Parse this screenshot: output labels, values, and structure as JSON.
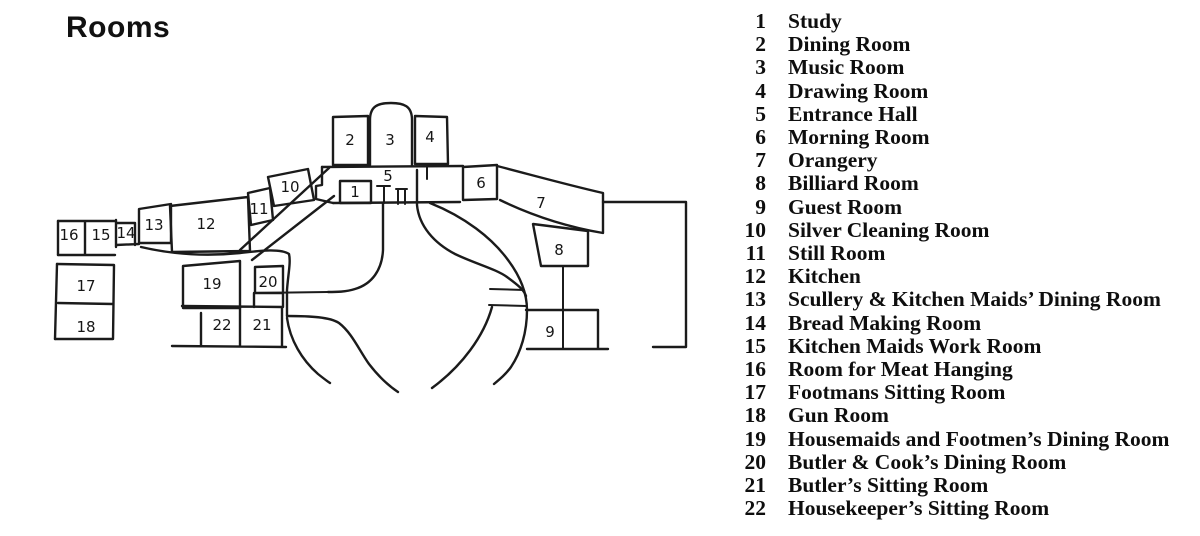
{
  "title": "Rooms",
  "colors": {
    "ink": "#1b1b1b",
    "paper": "#ffffff",
    "text": "#0e0e0e"
  },
  "legend": {
    "items": [
      {
        "num": "1",
        "name": "Study"
      },
      {
        "num": "2",
        "name": "Dining Room"
      },
      {
        "num": "3",
        "name": "Music Room"
      },
      {
        "num": "4",
        "name": "Drawing Room"
      },
      {
        "num": "5",
        "name": "Entrance Hall"
      },
      {
        "num": "6",
        "name": "Morning Room"
      },
      {
        "num": "7",
        "name": "Orangery"
      },
      {
        "num": "8",
        "name": "Billiard Room"
      },
      {
        "num": "9",
        "name": "Guest Room"
      },
      {
        "num": "10",
        "name": "Silver Cleaning Room"
      },
      {
        "num": "11",
        "name": "Still Room"
      },
      {
        "num": "12",
        "name": "Kitchen"
      },
      {
        "num": "13",
        "name": "Scullery & Kitchen Maids’ Dining Room"
      },
      {
        "num": "14",
        "name": "Bread Making Room"
      },
      {
        "num": "15",
        "name": "Kitchen Maids Work Room"
      },
      {
        "num": "16",
        "name": "Room for Meat Hanging"
      },
      {
        "num": "17",
        "name": "Footmans Sitting Room"
      },
      {
        "num": "18",
        "name": "Gun Room"
      },
      {
        "num": "19",
        "name": "Housemaids and Footmen’s Dining Room"
      },
      {
        "num": "20",
        "name": "Butler & Cook’s Dining Room"
      },
      {
        "num": "21",
        "name": "Butler’s Sitting Room"
      },
      {
        "num": "22",
        "name": "Housekeeper’s Sitting Room"
      }
    ]
  },
  "plan": {
    "labels": [
      {
        "num": "1"
      },
      {
        "num": "2"
      },
      {
        "num": "3"
      },
      {
        "num": "4"
      },
      {
        "num": "5"
      },
      {
        "num": "6"
      },
      {
        "num": "7"
      },
      {
        "num": "8"
      },
      {
        "num": "9"
      },
      {
        "num": "10"
      },
      {
        "num": "11"
      },
      {
        "num": "12"
      },
      {
        "num": "13"
      },
      {
        "num": "14"
      },
      {
        "num": "15"
      },
      {
        "num": "16"
      },
      {
        "num": "17"
      },
      {
        "num": "18"
      },
      {
        "num": "19"
      },
      {
        "num": "20"
      },
      {
        "num": "21"
      },
      {
        "num": "22"
      }
    ]
  }
}
